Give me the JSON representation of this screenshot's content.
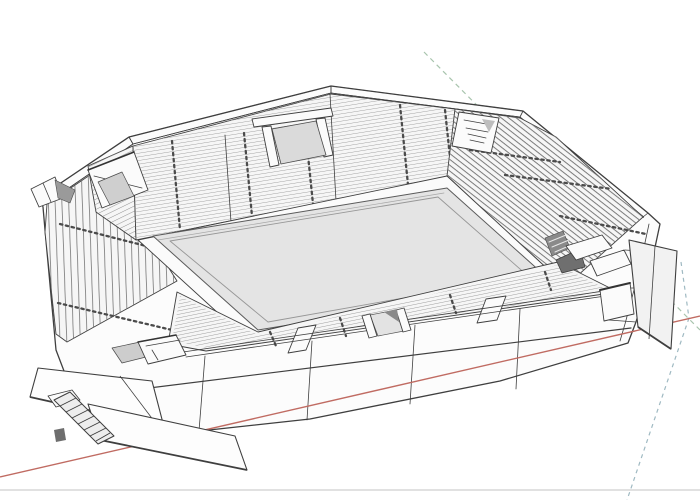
{
  "viewport": {
    "width": 700,
    "height": 500
  },
  "scene": {
    "subject": "stadium-3d-model",
    "style": "wireframe-sketch"
  },
  "colors": {
    "paper": "#ffffff",
    "ink": "#3f3f3f",
    "fill_light": "#f6f6f6",
    "fill_mid": "#dcdcdc",
    "fill_dark": "#a9a9a9",
    "field": "#e4e4e4",
    "red_axis": "#c06b62",
    "green_axis": "#a8c4ad",
    "blue_axis": "#9fb9c2",
    "border_line": "#cfcfcf"
  },
  "axes": {
    "red": {
      "x1": 0,
      "y1": 477,
      "x2": 700,
      "y2": 316
    },
    "green": {
      "x1": 424,
      "y1": 52,
      "x2": 700,
      "y2": 330
    },
    "blue_down": {
      "x1": 689,
      "y1": 318,
      "x2": 627,
      "y2": 500
    },
    "blue_up": {
      "x1": 681,
      "y1": 262,
      "x2": 689,
      "y2": 318
    }
  },
  "border": {
    "bottom_y": 490
  }
}
